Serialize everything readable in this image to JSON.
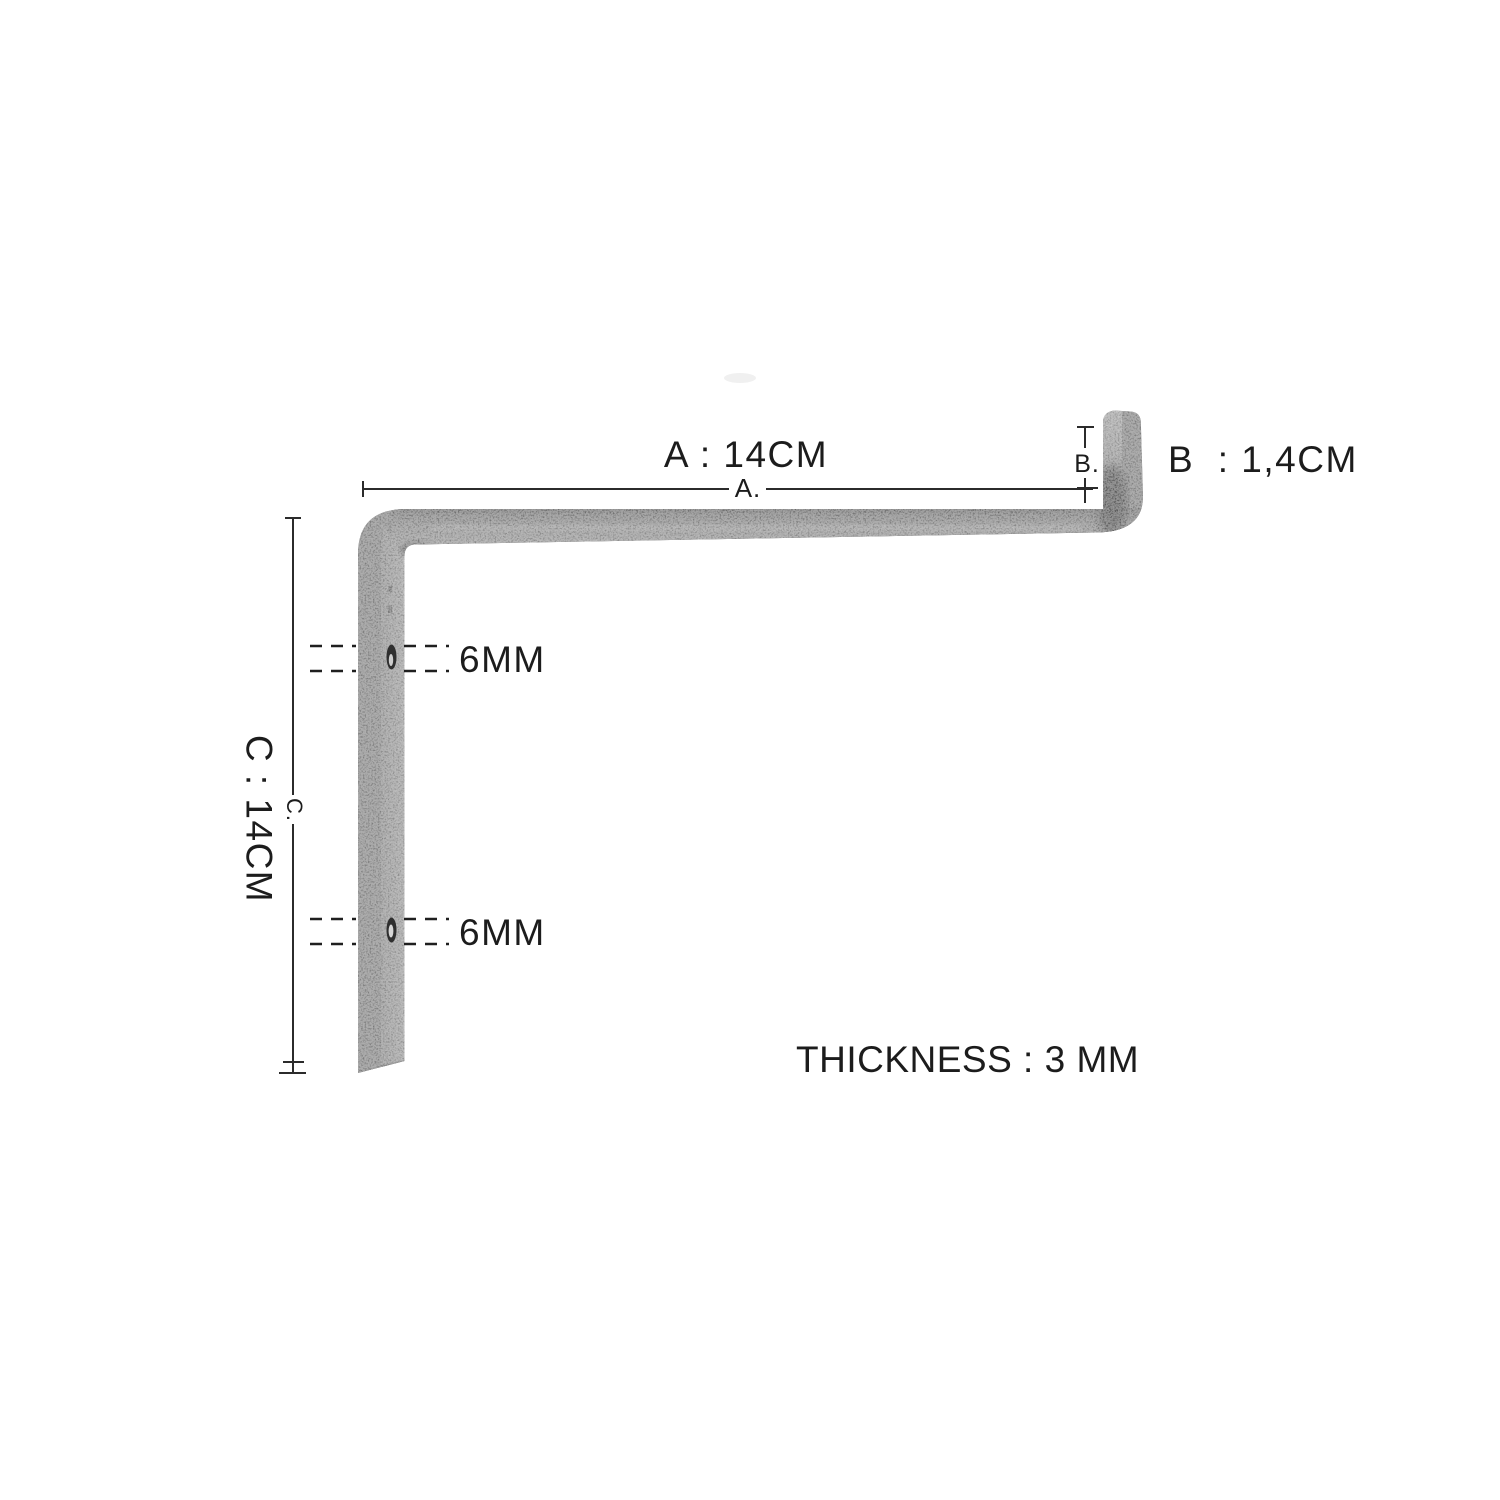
{
  "diagram": {
    "dimensions": {
      "a": {
        "label": "A : 14CM",
        "line_label": "A.",
        "value_cm": 14
      },
      "b": {
        "label": "B  : 1,4CM",
        "line_label": "B.",
        "value_cm": 1.4
      },
      "c": {
        "label": "C : 14CM",
        "line_label": "C.",
        "value_cm": 14
      },
      "hole_top": {
        "label": "6MM",
        "value_mm": 6
      },
      "hole_bottom": {
        "label": "6MM",
        "value_mm": 6
      },
      "thickness": {
        "label": "THICKNESS : 3 MM",
        "value_mm": 3
      }
    },
    "colors": {
      "background": "#ffffff",
      "metal_base": "#7d7d7d",
      "metal_side_light": "#a3a3a3",
      "metal_edge_dark": "#4f4f4f",
      "dimension_line": "#2b2b2b",
      "text": "#1c1c1c"
    }
  }
}
